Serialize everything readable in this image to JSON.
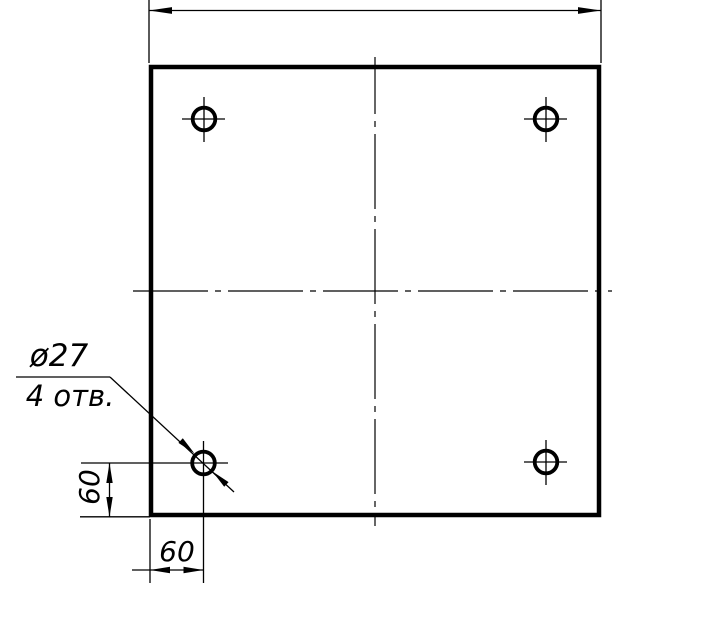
{
  "drawing": {
    "kind": "technical-drawing",
    "view": "square plate, front view, 4 drilled holes",
    "colors": {
      "line": "#000000",
      "background": "#ffffff"
    },
    "callout": {
      "diameter_label": "ø27",
      "count_label": "4 отв."
    },
    "dimensions": {
      "left_offset": "60",
      "bottom_offset": "60"
    }
  }
}
